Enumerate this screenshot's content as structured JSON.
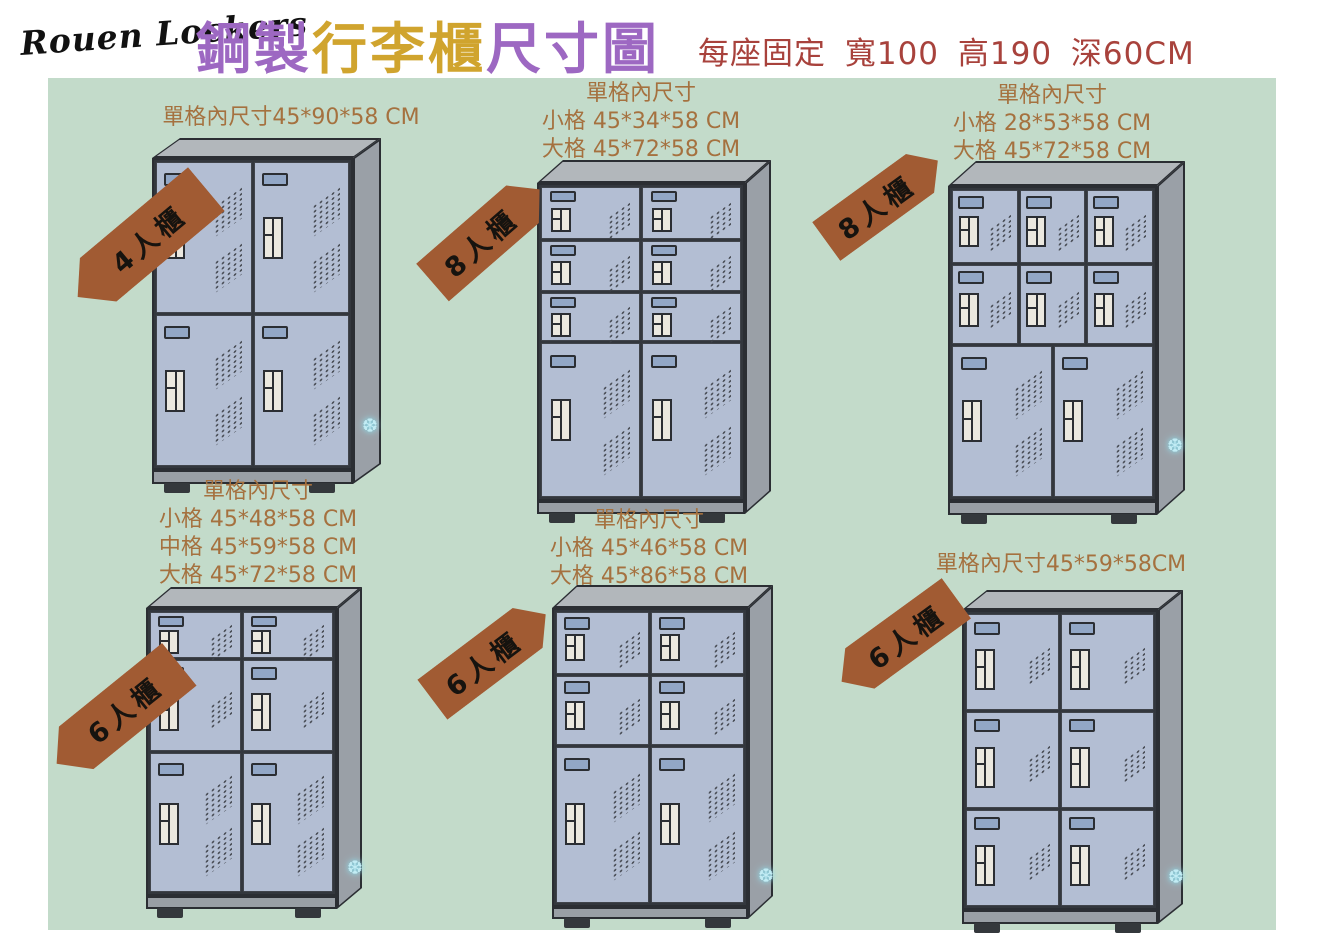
{
  "header": {
    "logo": "Rouen Lockers",
    "title_parts": [
      "鋼製",
      "行李櫃",
      "尺寸圖"
    ],
    "subtitle": "每座固定 寬100 高190 深60CM"
  },
  "palette": {
    "board_green": "#c3dbca",
    "tag_brown": "#a15b33",
    "label_brown": "#a5713f",
    "subtitle_red": "#a8423c",
    "title_purple": "#9d68c2",
    "title_gold": "#d0a42e",
    "door_blue": "#b3bed3",
    "cabinet_side_gray": "#9aa0a7",
    "cabinet_top_gray": "#b2b7bb",
    "outline_dark": "#2b2e33"
  },
  "sparkle_glyph": "❆",
  "lockers": [
    {
      "id": "4-door",
      "tag": {
        "label": "4人櫃",
        "cx": 142,
        "cy": 243,
        "w": 168,
        "h": 57,
        "angle": -40,
        "point": "left"
      },
      "dims": {
        "lines": [
          "單格內尺寸45*90*58  CM"
        ],
        "cx": 291,
        "top": 104
      },
      "geom": {
        "x": 152,
        "y": 158,
        "w": 201,
        "h": 312,
        "dx": 28,
        "dy": 20,
        "baseH": 14
      },
      "rows": [
        {
          "f": 0.5,
          "cols": 2
        },
        {
          "f": 0.5,
          "cols": 2
        }
      ],
      "sparkle": {
        "x": 210,
        "y": 277
      }
    },
    {
      "id": "8-door-stacked",
      "tag": {
        "label": "8人櫃",
        "cx": 486,
        "cy": 236,
        "w": 142,
        "h": 50,
        "angle": -41,
        "point": "right"
      },
      "dims": {
        "lines": [
          "單格內尺寸",
          "小格 45*34*58 CM",
          "大格 45*72*58 CM"
        ],
        "cx": 641,
        "top": 80
      },
      "geom": {
        "x": 537,
        "y": 183,
        "w": 208,
        "h": 318,
        "dx": 26,
        "dy": 23,
        "baseH": 13
      },
      "rows": [
        {
          "f": 0.17,
          "cols": 2
        },
        {
          "f": 0.165,
          "cols": 2
        },
        {
          "f": 0.16,
          "cols": 2
        },
        {
          "f": 0.505,
          "cols": 2
        }
      ],
      "sparkle": null
    },
    {
      "id": "8-door-mixed",
      "tag": {
        "label": "8人櫃",
        "cx": 882,
        "cy": 201,
        "w": 138,
        "h": 48,
        "angle": -36,
        "point": "right"
      },
      "dims": {
        "lines": [
          "單格內尺寸",
          "小格 28*53*58 CM",
          "大格 45*72*58 CM"
        ],
        "cx": 1052,
        "top": 82
      },
      "geom": {
        "x": 948,
        "y": 186,
        "w": 209,
        "h": 315,
        "dx": 28,
        "dy": 25,
        "baseH": 14
      },
      "rows": [
        {
          "f": 0.24,
          "cols": 3
        },
        {
          "f": 0.26,
          "cols": 3
        },
        {
          "f": 0.5,
          "cols": 2
        }
      ],
      "sparkle": {
        "x": 219,
        "y": 274
      }
    },
    {
      "id": "6-door-small-mid-large",
      "tag": {
        "label": "6人櫃",
        "cx": 118,
        "cy": 714,
        "w": 158,
        "h": 55,
        "angle": -39,
        "point": "left"
      },
      "dims": {
        "lines": [
          "單格內尺寸",
          "小格 45*48*58 CM",
          "中格 45*59*58 CM",
          "大格 45*72*58 CM"
        ],
        "cx": 258,
        "top": 478
      },
      "geom": {
        "x": 146,
        "y": 608,
        "w": 191,
        "h": 288,
        "dx": 25,
        "dy": 21,
        "baseH": 13
      },
      "rows": [
        {
          "f": 0.165,
          "cols": 2
        },
        {
          "f": 0.33,
          "cols": 2
        },
        {
          "f": 0.505,
          "cols": 2
        }
      ],
      "sparkle": {
        "x": 201,
        "y": 270
      }
    },
    {
      "id": "6-door-small-large",
      "tag": {
        "label": "6人櫃",
        "cx": 489,
        "cy": 657,
        "w": 142,
        "h": 50,
        "angle": -37,
        "point": "right"
      },
      "dims": {
        "lines": [
          "單格內尺寸",
          "小格 45*46*58 CM",
          "大格 45*86*58 CM"
        ],
        "cx": 649,
        "top": 507
      },
      "geom": {
        "x": 552,
        "y": 608,
        "w": 196,
        "h": 299,
        "dx": 25,
        "dy": 23,
        "baseH": 12
      },
      "rows": [
        {
          "f": 0.215,
          "cols": 2
        },
        {
          "f": 0.24,
          "cols": 2
        },
        {
          "f": 0.545,
          "cols": 2
        }
      ],
      "sparkle": {
        "x": 206,
        "y": 280
      }
    },
    {
      "id": "6-door-equal",
      "tag": {
        "label": "6人櫃",
        "cx": 899,
        "cy": 640,
        "w": 142,
        "h": 50,
        "angle": -36,
        "point": "left"
      },
      "dims": {
        "lines": [
          "單格內尺寸45*59*58CM"
        ],
        "cx": 1061,
        "top": 551
      },
      "geom": {
        "x": 962,
        "y": 610,
        "w": 196,
        "h": 300,
        "dx": 25,
        "dy": 20,
        "baseH": 14
      },
      "rows": [
        {
          "f": 0.333,
          "cols": 2
        },
        {
          "f": 0.333,
          "cols": 2
        },
        {
          "f": 0.334,
          "cols": 2
        }
      ],
      "sparkle": {
        "x": 206,
        "y": 276
      }
    }
  ]
}
